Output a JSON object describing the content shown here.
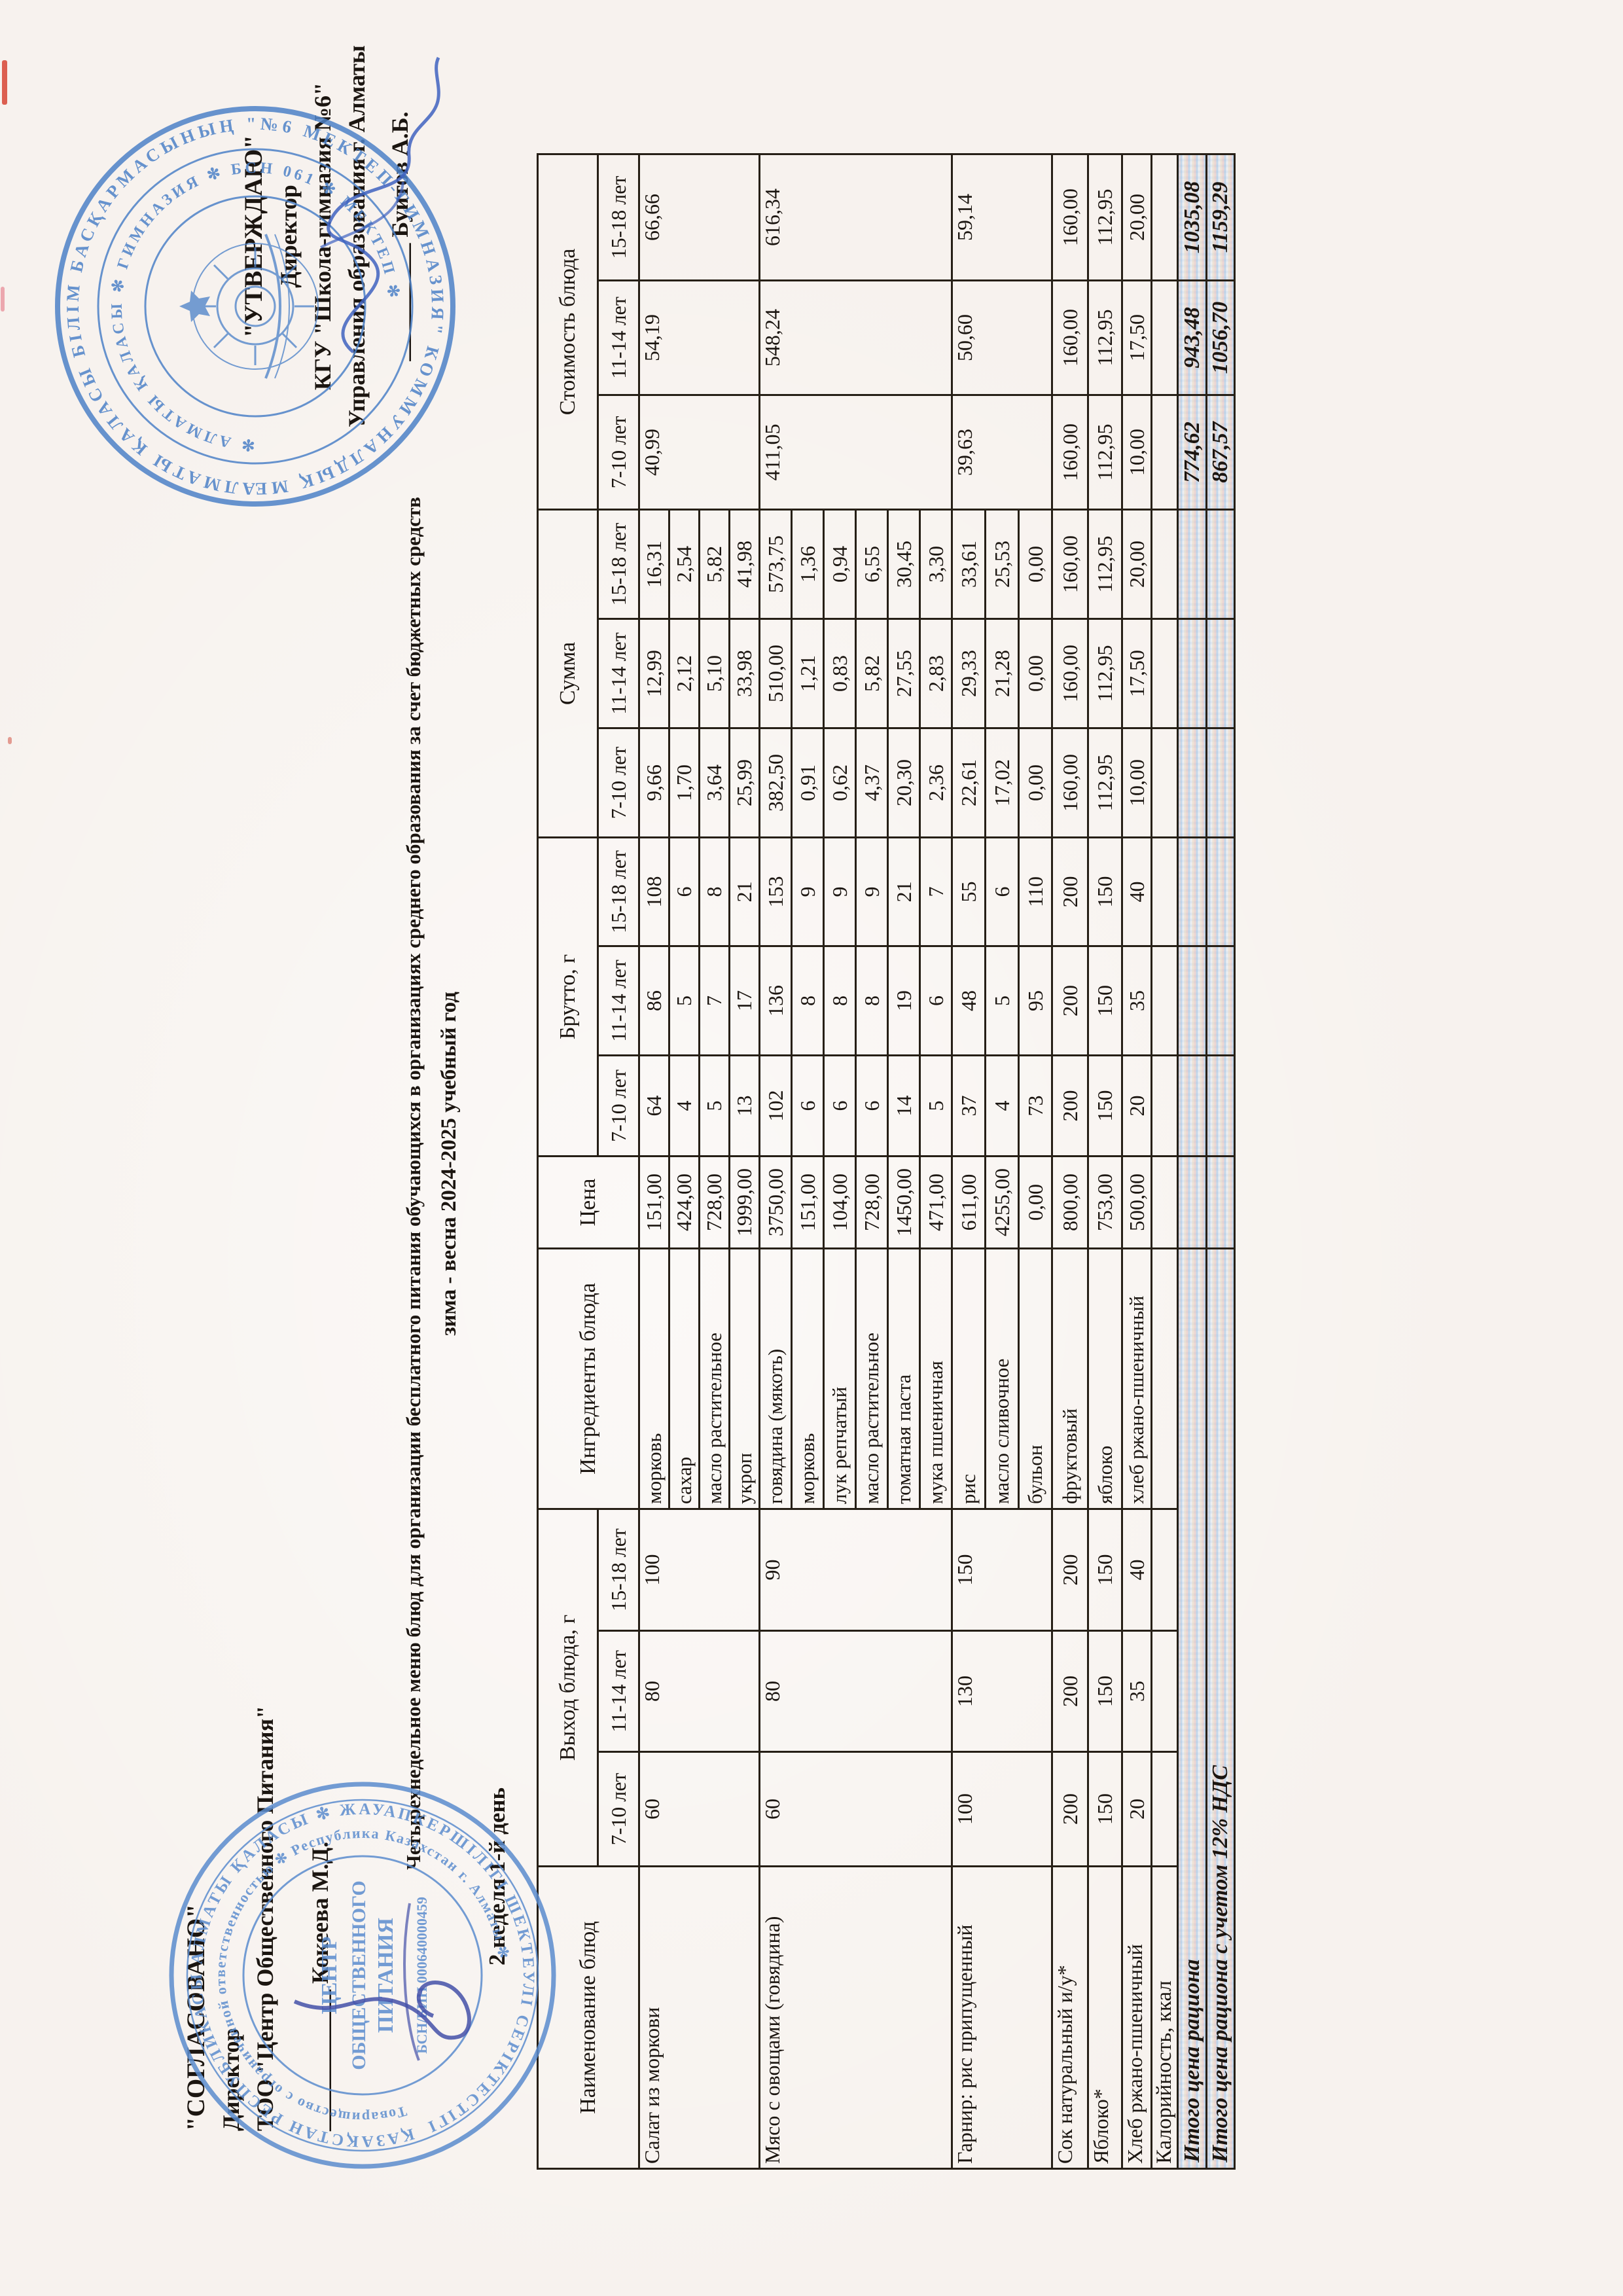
{
  "approved_left": {
    "title": "\"СОГЛАСОВАНО\"",
    "role": "Директор",
    "org": "ТОО \"Центр Общественного Питания\"",
    "sign_line": "____________",
    "name": "Кокеева М.Д."
  },
  "approved_right": {
    "title": "\"УТВЕРЖДАЮ\"",
    "role": "Директор",
    "org": "КГУ \"Школа-гимназия №6\"",
    "dept": "Управления образования г. Алматы",
    "sign_line": "__________",
    "name": "Буитов А.Б."
  },
  "title_line1": "Четырехнедельное меню блюд для организации бесплатного питания обучающихся в организациях среднего образования за счет бюджетных средств",
  "title_line2": "зима - весна 2024-2025 учебный год",
  "day_label": "2 неделя 1-й день",
  "table": {
    "col_name": "Наименование блюд",
    "col_vykhod": "Выход блюда, г",
    "col_ingredients": "Ингредиенты блюда",
    "col_price": "Цена",
    "col_brutto": "Брутто, г",
    "col_summa": "Сумма",
    "col_cost": "Стоимость блюда",
    "ages": [
      "7-10 лет",
      "11-14 лет",
      "15-18 лет"
    ],
    "dishes": [
      {
        "name": "Салат из моркови",
        "out": [
          "60",
          "80",
          "100"
        ],
        "cost": [
          "40,99",
          "54,19",
          "66,66"
        ],
        "rows": [
          {
            "ing": "морковь",
            "price": "151,00",
            "brutto": [
              "64",
              "86",
              "108"
            ],
            "summa": [
              "9,66",
              "12,99",
              "16,31"
            ]
          },
          {
            "ing": "сахар",
            "price": "424,00",
            "brutto": [
              "4",
              "5",
              "6"
            ],
            "summa": [
              "1,70",
              "2,12",
              "2,54"
            ]
          },
          {
            "ing": "масло растительное",
            "price": "728,00",
            "brutto": [
              "5",
              "7",
              "8"
            ],
            "summa": [
              "3,64",
              "5,10",
              "5,82"
            ]
          },
          {
            "ing": "укроп",
            "price": "1999,00",
            "brutto": [
              "13",
              "17",
              "21"
            ],
            "summa": [
              "25,99",
              "33,98",
              "41,98"
            ]
          }
        ]
      },
      {
        "name": "Мясо с овощами (говядина)",
        "out": [
          "60",
          "80",
          "90"
        ],
        "cost": [
          "411,05",
          "548,24",
          "616,34"
        ],
        "rows": [
          {
            "ing": "говядина (мякоть)",
            "price": "3750,00",
            "brutto": [
              "102",
              "136",
              "153"
            ],
            "summa": [
              "382,50",
              "510,00",
              "573,75"
            ]
          },
          {
            "ing": "морковь",
            "price": "151,00",
            "brutto": [
              "6",
              "8",
              "9"
            ],
            "summa": [
              "0,91",
              "1,21",
              "1,36"
            ]
          },
          {
            "ing": "лук репчатый",
            "price": "104,00",
            "brutto": [
              "6",
              "8",
              "9"
            ],
            "summa": [
              "0,62",
              "0,83",
              "0,94"
            ]
          },
          {
            "ing": "масло растительное",
            "price": "728,00",
            "brutto": [
              "6",
              "8",
              "9"
            ],
            "summa": [
              "4,37",
              "5,82",
              "6,55"
            ]
          },
          {
            "ing": "томатная паста",
            "price": "1450,00",
            "brutto": [
              "14",
              "19",
              "21"
            ],
            "summa": [
              "20,30",
              "27,55",
              "30,45"
            ]
          },
          {
            "ing": "мука пшеничная",
            "price": "471,00",
            "brutto": [
              "5",
              "6",
              "7"
            ],
            "summa": [
              "2,36",
              "2,83",
              "3,30"
            ]
          }
        ]
      },
      {
        "name": "Гарнир: рис припущенный",
        "out": [
          "100",
          "130",
          "150"
        ],
        "cost": [
          "39,63",
          "50,60",
          "59,14"
        ],
        "rows": [
          {
            "ing": "рис",
            "price": "611,00",
            "brutto": [
              "37",
              "48",
              "55"
            ],
            "summa": [
              "22,61",
              "29,33",
              "33,61"
            ]
          },
          {
            "ing": "масло сливочное",
            "price": "4255,00",
            "brutto": [
              "4",
              "5",
              "6"
            ],
            "summa": [
              "17,02",
              "21,28",
              "25,53"
            ]
          },
          {
            "ing": "бульон",
            "price": "0,00",
            "brutto": [
              "73",
              "95",
              "110"
            ],
            "summa": [
              "0,00",
              "0,00",
              "0,00"
            ]
          }
        ]
      },
      {
        "name": "Сок натуральный и/у*",
        "out": [
          "200",
          "200",
          "200"
        ],
        "cost": [
          "160,00",
          "160,00",
          "160,00"
        ],
        "rows": [
          {
            "ing": "фруктовый",
            "price": "800,00",
            "brutto": [
              "200",
              "200",
              "200"
            ],
            "summa": [
              "160,00",
              "160,00",
              "160,00"
            ]
          }
        ]
      },
      {
        "name": "Яблоко*",
        "out": [
          "150",
          "150",
          "150"
        ],
        "cost": [
          "112,95",
          "112,95",
          "112,95"
        ],
        "rows": [
          {
            "ing": "яблоко",
            "price": "753,00",
            "brutto": [
              "150",
              "150",
              "150"
            ],
            "summa": [
              "112,95",
              "112,95",
              "112,95"
            ]
          }
        ]
      },
      {
        "name": "Хлеб ржано-пшеничный",
        "out": [
          "20",
          "35",
          "40"
        ],
        "cost": [
          "10,00",
          "17,50",
          "20,00"
        ],
        "rows": [
          {
            "ing": "хлеб ржано-пшеничный",
            "price": "500,00",
            "brutto": [
              "20",
              "35",
              "40"
            ],
            "summa": [
              "10,00",
              "17,50",
              "20,00"
            ]
          }
        ]
      }
    ],
    "calories_label": "Калорийность, ккал",
    "totals": [
      {
        "label": "Итого цена рациона",
        "values": [
          "774,62",
          "943,48",
          "1035,08"
        ]
      },
      {
        "label": "Итого цена рациона с учетом 12% НДС",
        "values": [
          "867,57",
          "1056,70",
          "1159,29"
        ]
      }
    ]
  },
  "stamps": {
    "right_outer": "АЛМАТЫ ҚАЛАСЫ БІЛІМ БАСҚАРМАСЫНЫҢ \"№6 МЕКТЕП-ГИМНАЗИЯ\" КОММУНАЛДЫҚ МЕМЛЕКЕТТІК МЕКЕМЕСІ ✻",
    "right_inner": "✻ АЛМАТЫ ҚАЛАСЫ ✻ ГИМНАЗИЯ ✻ БСН 061 ✻ МЕКТЕП ✻",
    "left_outer": "ҚАЗАҚСТАН РЕСПУБЛИКАСЫ АЛМАТЫ ҚАЛАСЫ ✻ ЖАУАПКЕРШІЛІГІ ШЕКТЕУЛІ СЕРІКТЕСТІГІ ✻",
    "left_inner": "Товарищество с ограниченной ответственностью ✻ Республика Казахстан г. Алматы ✻",
    "left_center1": "ЦЕНТР",
    "left_center2": "ОБЩЕСТВЕННОГО",
    "left_center3": "ПИТАНИЯ",
    "left_bin": "БСН/БИН 000640000459"
  }
}
